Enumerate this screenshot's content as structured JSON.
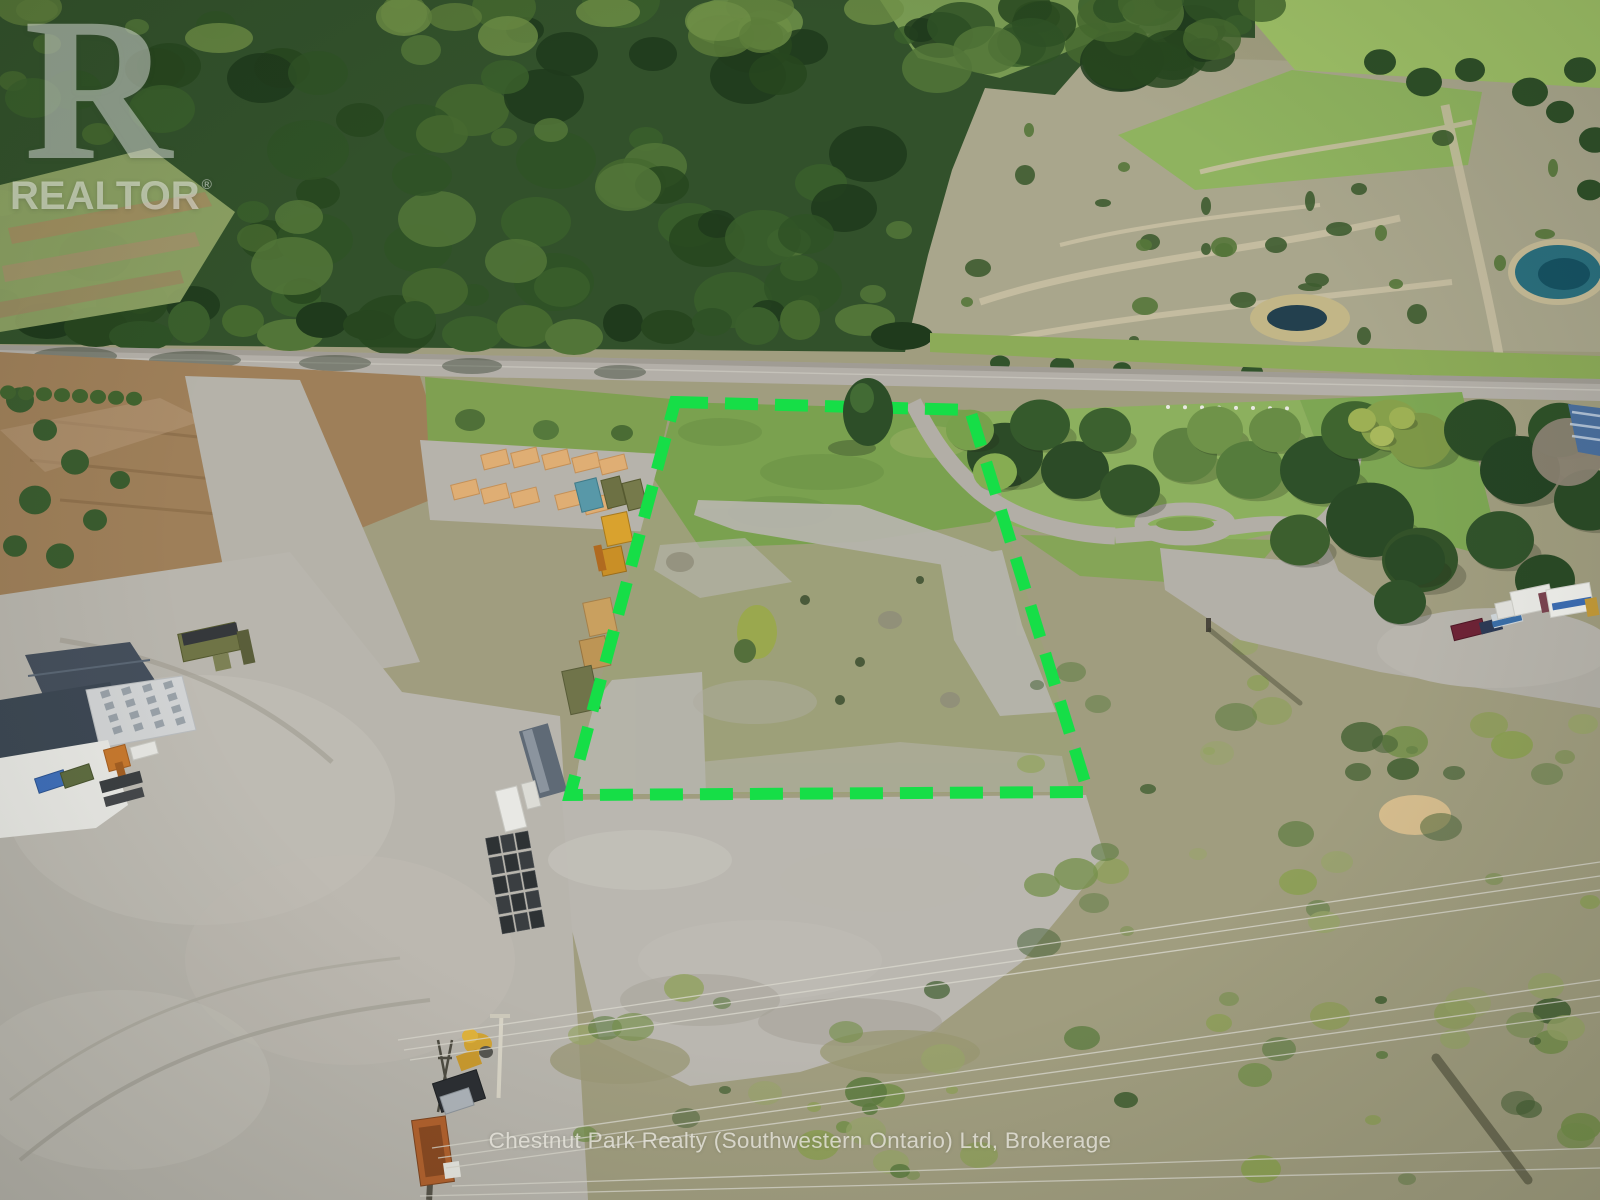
{
  "watermark": {
    "logo_letter": "R",
    "logo_text": "REALTOR",
    "registered_symbol": "®",
    "brokerage_line": "Chestnut Park Realty (Southwestern Ontario) Ltd, Brokerage"
  },
  "boundary_overlay": {
    "color": "#16DE47",
    "stroke_width": 12,
    "dash_length": 33,
    "gap_length": 17,
    "points": "675,402 970,410 1088,792 570,795"
  }
}
